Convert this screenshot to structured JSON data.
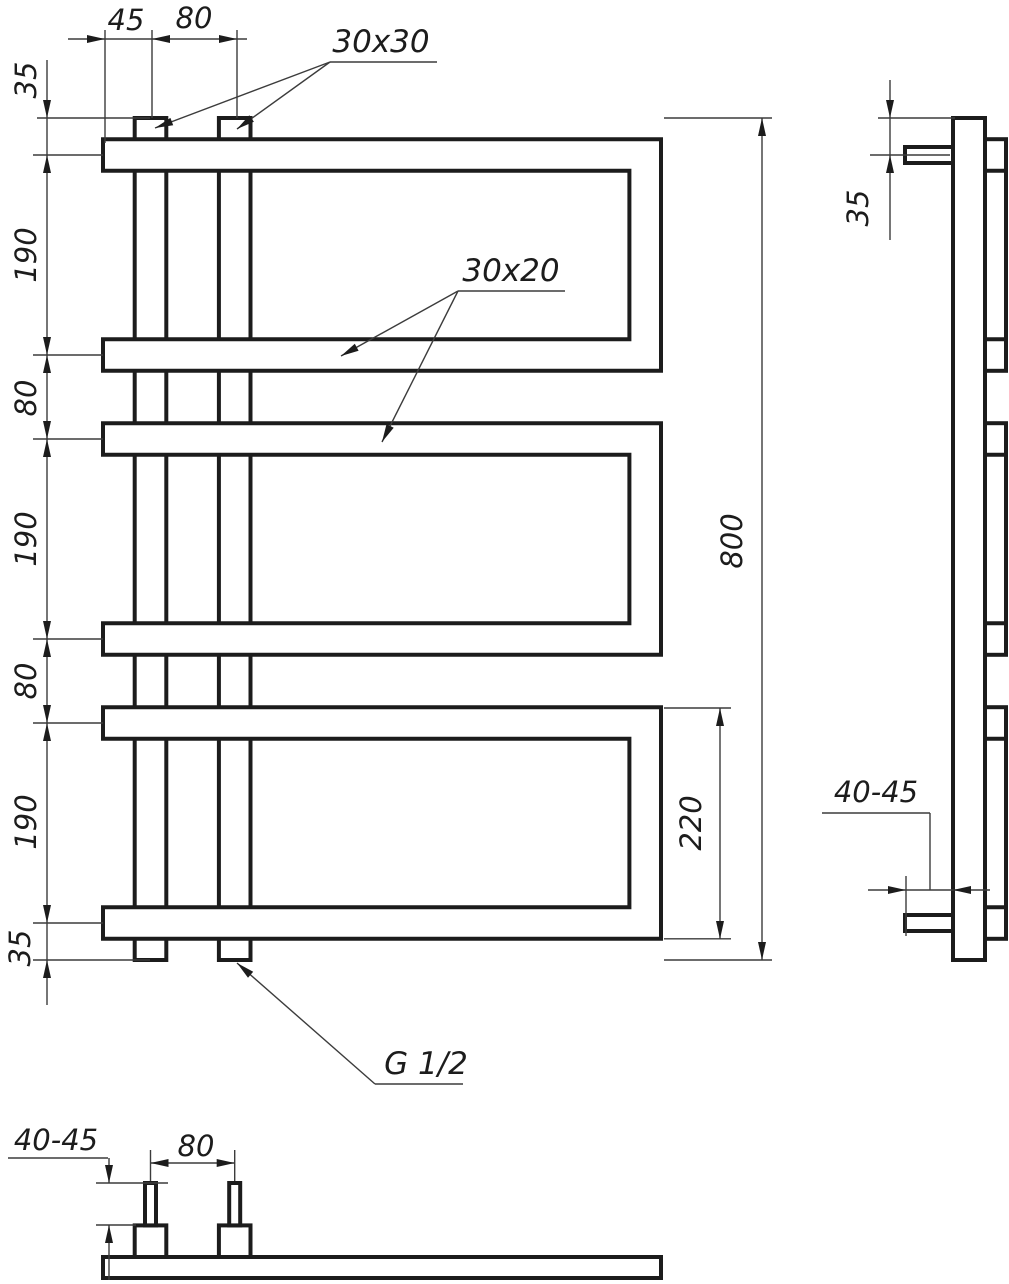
{
  "front_view": {
    "top_chain": {
      "d45": "45",
      "d80": "80"
    },
    "left_chain": {
      "d35_top": "35",
      "d190_a": "190",
      "d80_a": "80",
      "d190_b": "190",
      "d80_b": "80",
      "d190_c": "190",
      "d35_bottom": "35"
    },
    "d800": "800",
    "d220": "220",
    "callouts": {
      "riser_profile": "30x30",
      "rung_profile": "30x20",
      "thread": "G 1/2"
    }
  },
  "side_view": {
    "d35": "35",
    "d40_45": "40-45"
  },
  "bottom_view": {
    "d80": "80",
    "d40_45": "40-45"
  },
  "colors": {
    "line": "#1c1c1c",
    "dim": "#3c3c3c",
    "background": "#ffffff"
  }
}
